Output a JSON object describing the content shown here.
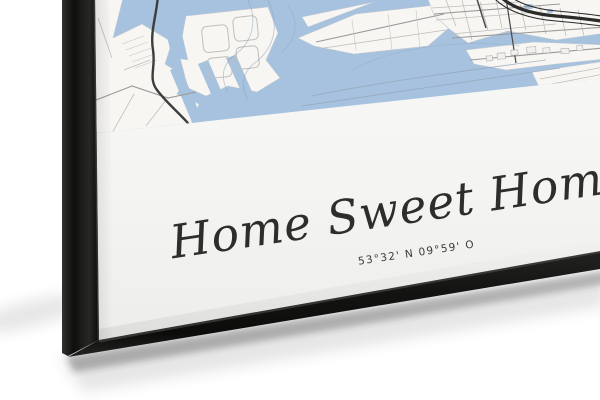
{
  "scene": {
    "background_color": "#ffffff",
    "frame_color": "#1b1b1a",
    "shadow_color": "#2a2a2a"
  },
  "poster": {
    "title": "Home Sweet Home",
    "coordinates": "53°32' N 09°59' O",
    "paper_color": "#f6f6f5",
    "text_color": "#2e2d2c"
  },
  "map": {
    "water_color": "#a6c2de",
    "land_color": "#f7f6f3",
    "main_road_color": "#3d3d3c",
    "highway_color": "#2b2b2a",
    "street_color": "#bdbab7",
    "contour_color": "#8aa0bb"
  }
}
